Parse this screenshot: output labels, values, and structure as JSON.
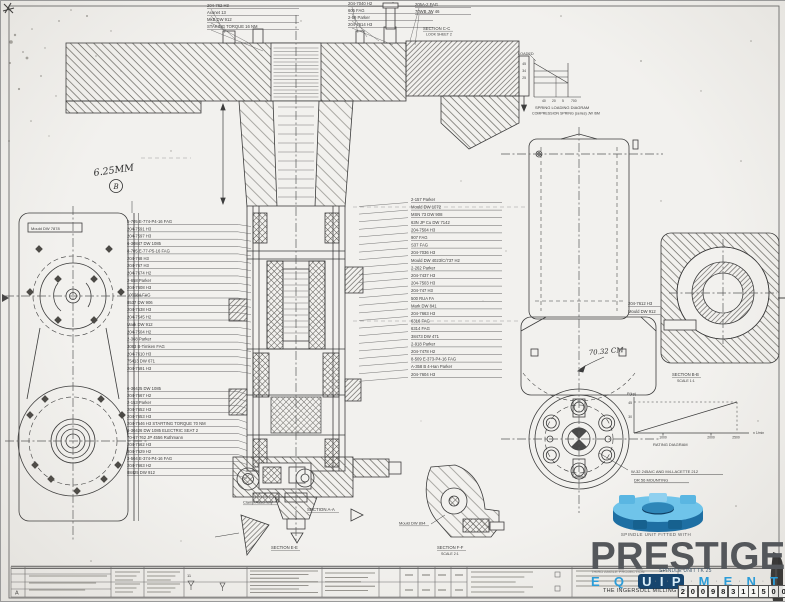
{
  "colors": {
    "paper": "#f2f1ee",
    "ink": "#3c3c3c",
    "accent_blue": "#2b9cd8",
    "brand_gray": "#54575b",
    "navy": "#17456e"
  },
  "handnote": {
    "value": "6.25MM",
    "flag": "B"
  },
  "top_callouts": {
    "left": [
      "204-762 H3",
      "Axonet 13",
      "MkB DW 912",
      "STAKING TORQUE 16 NM"
    ],
    "right": [
      "204-7040 H2",
      "605 FAG",
      "2-59 Parker",
      "204-7614 H3"
    ],
    "far": [
      "205A-2 FAG",
      "70WB JW 46"
    ]
  },
  "callouts": {
    "left": [
      "8-705 E-774-P4-16  FAG",
      "204-7591 H3",
      "204-7597 H3",
      "6-30847 DW 1085",
      "8-705 E-77-P5-16  FAG",
      "204-768 H3",
      "204-767 H3",
      "204-7674 H2",
      "2-658 Parker",
      "204-7608 H3",
      "100084 FAG",
      "8537 DW 906",
      "204-7538 H3",
      "204-7545 H2",
      "Mark DW 912",
      "204-7504 H2",
      "2-368 Parker",
      "3083 B-Timken FAG",
      "204-7610 H3",
      "75413 DW 671",
      "204-7591 H3",
      "6-30425 DW 1085",
      "204-7567 H2",
      "2-153 Parker",
      "204-7652 H3",
      "204-7653 H3",
      "204-7546 H3  STARTING TORQUE 70 NM",
      "6-30426 DW 1085  ELECTRIC SEAT 2",
      "70-67-762 JP 4556 Ruthmann",
      "204-7562 H3",
      "204-7529 H2",
      "3-504 E-374-P4-16  FAG",
      "204-7663 H2",
      "88425 DW 912"
    ],
    "right": [
      "2-157 Parker",
      "Mould DW 1072",
      "MSN 73 DW 908",
      "63N JP Cu DW 7142",
      "204-7504 H3",
      "907 FAG",
      "S37 FAG",
      "204-7036 H3",
      "Mould DW 4023/C/737 H2",
      "2-262 Parker",
      "204-7437 H3",
      "204-7503 H3",
      "204-747 H3",
      "500 RUA FA",
      "Mark DW 841",
      "204-7663 H3",
      "6316 FAG",
      "6314 FAG",
      "38473 DW 471",
      "2-918 Parker",
      "204-7478 H2",
      "8-509 E-373-P4-16  FAG",
      "A-358 B 4-Han Parker",
      "204-7604 H3"
    ],
    "far_right": [
      "204-7612 H3",
      "Mould DW 912"
    ]
  },
  "labels": {
    "gearbox": "Mould DW 7878",
    "mould_894": "Mould DW 894",
    "clamp": "Clamp Assembly",
    "dim70": "70.32 CM",
    "annot1": "W-32 245A/C AND M4-LACETTE 212",
    "annot2": "DR 56 MOUNTING"
  },
  "sections": {
    "cc": "SECTION C-C",
    "cc_sub": "LOOK SHEET 2",
    "aa": "SECTION A-A",
    "bb": "SECTION B-B",
    "bb_scale": "SCALE 1:1",
    "ee": "SECTION E-E",
    "ff": "SECTION F-F",
    "ff_scale": "SCALE 2:1"
  },
  "spring_diagram": {
    "loaded": "LOADED",
    "caption1": "SPRING LOADING DIAGRAM",
    "caption2": "COMPRESSION SPRING (series) JW /6M",
    "y_ticks": [
      "45",
      "34",
      "25"
    ],
    "x_ticks": [
      "40",
      "20",
      "5",
      "700"
    ]
  },
  "rating_diagram": {
    "caption": "RATING DIAGRAM",
    "ylabel": "P(kp)",
    "y_ticks": [
      "45",
      "30"
    ],
    "x_ticks": [
      "1000",
      "2000",
      "2500"
    ],
    "xlabel": "n 1/min"
  },
  "chart_data": [
    {
      "type": "line",
      "title": "SPRING LOADING DIAGRAM",
      "subtitle": "COMPRESSION SPRING (series) JW /6M",
      "x": [
        5,
        20,
        40,
        700
      ],
      "series": [
        {
          "name": "spring load",
          "values": [
            45,
            34,
            25,
            25
          ]
        }
      ],
      "legend": false,
      "grid": false
    },
    {
      "type": "line",
      "title": "RATING DIAGRAM",
      "xlabel": "n 1/min",
      "ylabel": "P(kp)",
      "x": [
        0,
        1000,
        2000,
        2500
      ],
      "series": [
        {
          "name": "power",
          "values": [
            0,
            18,
            36,
            45
          ]
        }
      ],
      "annotations": [
        "dashed max-power line at 45 up to 2500"
      ],
      "legend": false,
      "grid": false
    }
  ],
  "title_block": {
    "rev_letter": "A",
    "symbol_count": "11"
  },
  "watermark": {
    "tagline": "SPINDLE UNIT FITTED WITH",
    "brand": "PRESTIGE",
    "equipment_letters": [
      "E",
      "Q",
      "U",
      "I",
      "P",
      "M",
      "E",
      "N",
      "T"
    ],
    "company": "THE INGERSOLL MILLING MACHINE CO.",
    "digits": [
      "2",
      "0",
      "0",
      "9",
      "8",
      "3",
      "1",
      "1",
      "5",
      "0",
      "0"
    ],
    "doc_title": "SPINDLE UNIT TK 25",
    "proj_note": "THIRD ANGLE PROJECTION"
  }
}
